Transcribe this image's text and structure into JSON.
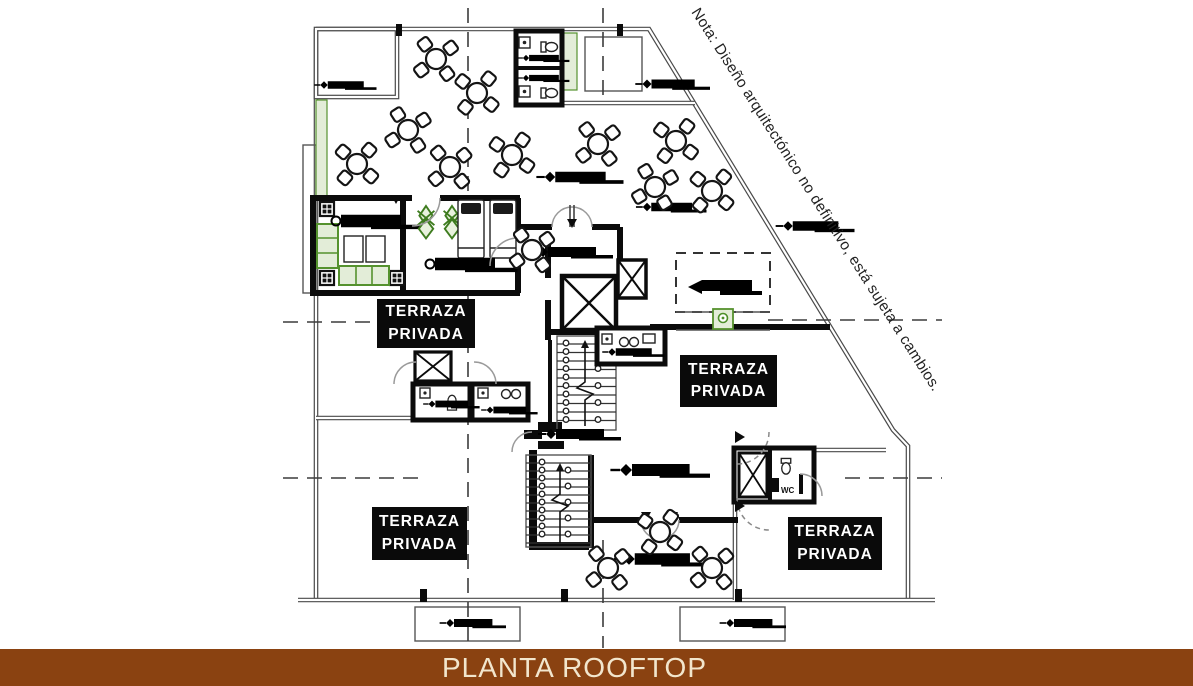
{
  "banner": {
    "title": "PLANTA ROOFTOP",
    "bg_color": "#8a4211",
    "text_color": "#f2e6cd"
  },
  "note": {
    "text": "Nota: Diseño arquitectónico no definitivo, está sujeta a cambios."
  },
  "terraces": [
    {
      "line1": "TERRAZA",
      "line2": "PRIVADA"
    },
    {
      "line1": "TERRAZA",
      "line2": "PRIVADA"
    },
    {
      "line1": "TERRAZA",
      "line2": "PRIVADA"
    },
    {
      "line1": "TERRAZA",
      "line2": "PRIVADA"
    }
  ],
  "rooms": {
    "wc_label": "WC"
  },
  "palette": {
    "wall": "#0b0b0b",
    "thin_line": "#4a4a4a",
    "dash_line": "#3c3c3c",
    "green_stroke": "#55922e",
    "green_fill": "#e3edd8"
  },
  "icons": {
    "elevator": "x-crossed-shaft",
    "stairs": "tread-run-with-arrow",
    "table": "round-table-4-chairs",
    "column": "quad-grid-column",
    "door": "quarter-arc-swing",
    "label_bar": "black-bar-with-diamond",
    "plant": "green-plant",
    "toilet": "toilet-outline"
  }
}
